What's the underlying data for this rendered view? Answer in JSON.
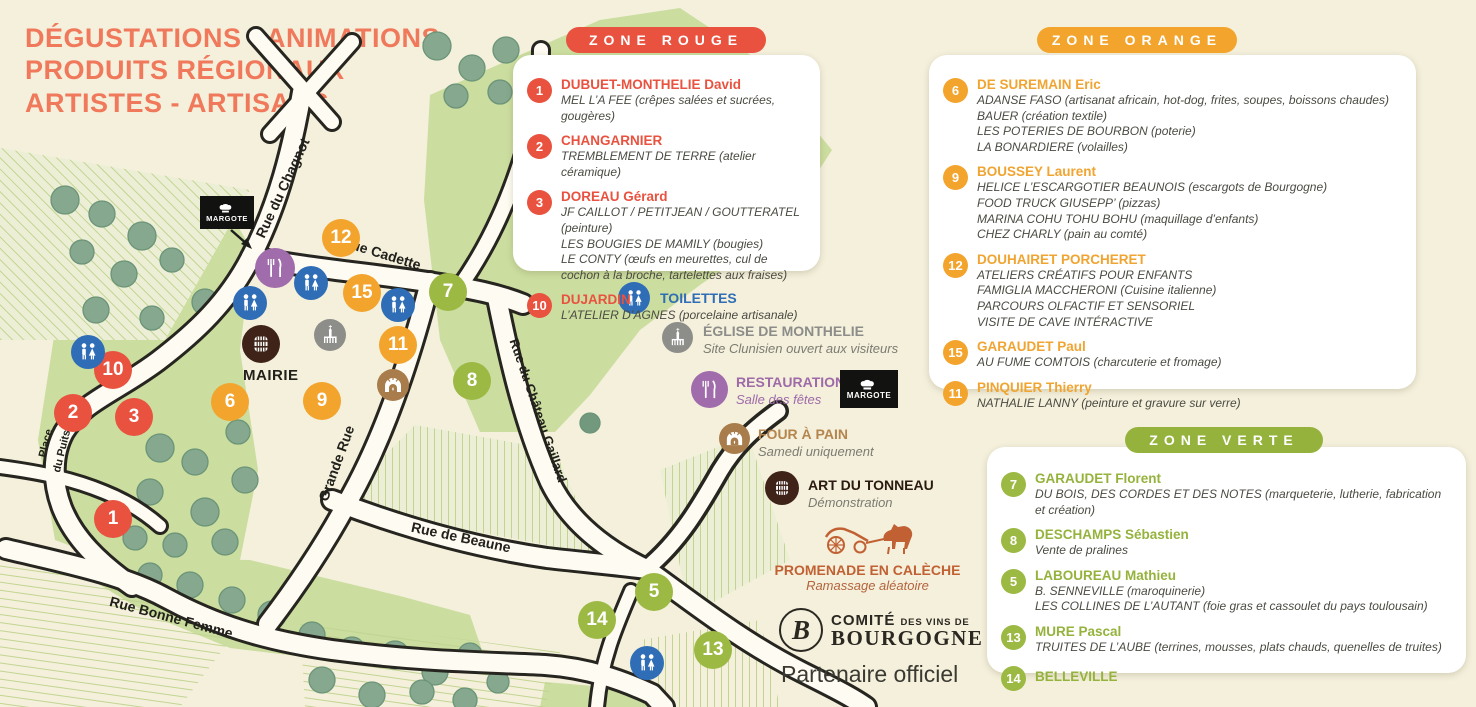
{
  "page": {
    "title_lines": [
      "DÉGUSTATIONS - ANIMATIONS",
      "PRODUITS RÉGIONAUX",
      "ARTISTES - ARTISANS"
    ]
  },
  "colors": {
    "red": "#e8523f",
    "orange": "#f3a42c",
    "green": "#95b33c",
    "blue": "#2f6eb6",
    "purple": "#a06cab",
    "gray": "#8d8d8a",
    "tan": "#a87d4b",
    "dark_brown": "#3f2318",
    "carriage": "#c16133",
    "cream": "#f4f0dc"
  },
  "zones": {
    "rouge": {
      "label": "ZONE ROUGE",
      "items": [
        {
          "n": "1",
          "title": "DUBUET-MONTHELIE David",
          "lines": [
            "MEL L’A FEE (crêpes salées et sucrées, gougères)"
          ]
        },
        {
          "n": "2",
          "title": "CHANGARNIER",
          "lines": [
            "TREMBLEMENT DE TERRE (atelier céramique)"
          ]
        },
        {
          "n": "3",
          "title": "DOREAU Gérard",
          "lines": [
            "JF CAILLOT / PETITJEAN / GOUTTERATEL (peinture)",
            "LES BOUGIES DE MAMILY (bougies)",
            "LE CONTY (œufs en meurettes, cul de cochon à la broche, tartelettes aux fraises)"
          ]
        },
        {
          "n": "10",
          "title": "DUJARDIN",
          "lines": [
            "L’ATELIER D’AGNES (porcelaine artisanale)"
          ]
        }
      ]
    },
    "orange": {
      "label": "ZONE ORANGE",
      "items": [
        {
          "n": "6",
          "title": "DE SUREMAIN Eric",
          "lines": [
            "ADANSE FASO (artisanat africain, hot-dog, frites, soupes, boissons chaudes)",
            "BAUER (création textile)",
            "LES POTERIES DE BOURBON (poterie)",
            "LA BONARDIERE (volailles)"
          ]
        },
        {
          "n": "9",
          "title": "BOUSSEY Laurent",
          "lines": [
            "HELICE L’ESCARGOTIER BEAUNOIS (escargots de Bourgogne)",
            "FOOD TRUCK GIUSEPP’ (pizzas)",
            "MARINA COHU TOHU BOHU (maquillage d’enfants)",
            "CHEZ CHARLY (pain au comté)"
          ]
        },
        {
          "n": "12",
          "title": "DOUHAIRET PORCHERET",
          "lines": [
            "ATELIERS CRÉATIFS POUR ENFANTS",
            "FAMIGLIA MACCHERONI (Cuisine italienne)",
            "PARCOURS OLFACTIF ET SENSORIEL",
            "VISITE DE CAVE INTÉRACTIVE"
          ]
        },
        {
          "n": "15",
          "title": "GARAUDET Paul",
          "lines": [
            "AU FUME COMTOIS (charcuterie et fromage)"
          ]
        },
        {
          "n": "11",
          "title": "PINQUIER Thierry",
          "lines": [
            "NATHALIE LANNY (peinture et gravure sur verre)"
          ]
        }
      ]
    },
    "verte": {
      "label": "ZONE VERTE",
      "items": [
        {
          "n": "7",
          "title": "GARAUDET Florent",
          "lines": [
            "DU BOIS, DES CORDES ET DES NOTES (marqueterie, lutherie, fabrication et création)"
          ]
        },
        {
          "n": "8",
          "title": "DESCHAMPS Sébastien",
          "lines": [
            "Vente de pralines"
          ]
        },
        {
          "n": "5",
          "title": "LABOUREAU Mathieu",
          "lines": [
            "B. SENNEVILLE (maroquinerie)",
            "LES COLLINES DE L’AUTANT (foie gras et cassoulet du pays toulousain)"
          ]
        },
        {
          "n": "13",
          "title": "MURE Pascal",
          "lines": [
            "TRUITES DE L’AUBE (terrines, mousses, plats chauds, quenelles de truites)"
          ]
        },
        {
          "n": "14",
          "title": "BELLEVILLE",
          "lines": []
        }
      ]
    }
  },
  "legend": {
    "toilettes": {
      "label": "TOILETTES"
    },
    "eglise": {
      "label": "ÉGLISE DE MONTHELIE",
      "sub": "Site Clunisien ouvert aux visiteurs"
    },
    "restauration": {
      "label": "RESTAURATION",
      "sub": "Salle des fêtes",
      "badge": "MARGOTE"
    },
    "four_a_pain": {
      "label": "FOUR À PAIN",
      "sub": "Samedi uniquement"
    },
    "tonneau": {
      "label": "ART DU TONNEAU",
      "sub": "Démonstration"
    },
    "caleche": {
      "label": "PROMENADE EN CALÈCHE",
      "sub": "Ramassage aléatoire"
    }
  },
  "partner": {
    "logo_letter": "B",
    "logo_word1": "COMITÉ",
    "logo_word2": "DES VINS DE",
    "logo_word3": "BOURGOGNE",
    "tagline": "Partenaire officiel"
  },
  "map": {
    "labels": {
      "mairie": "MAIRIE",
      "margote": "MARGOTE"
    },
    "streets": {
      "chagnot": "Rue du Chagnot",
      "cadette": "Rue Cadette",
      "grande": "Grande Rue",
      "beaune": "Rue de Beaune",
      "bonne_femme": "Rue Bonne Femme",
      "place_l1": "Place",
      "place_l2": "du Puits",
      "gaillard": "Rue du Château Gaillard"
    },
    "markers": [
      {
        "n": "1"
      },
      {
        "n": "2"
      },
      {
        "n": "3"
      },
      {
        "n": "10"
      },
      {
        "n": "6"
      },
      {
        "n": "9"
      },
      {
        "n": "11"
      },
      {
        "n": "12"
      },
      {
        "n": "15"
      },
      {
        "n": "5"
      },
      {
        "n": "7"
      },
      {
        "n": "8"
      },
      {
        "n": "13"
      },
      {
        "n": "14"
      }
    ]
  }
}
